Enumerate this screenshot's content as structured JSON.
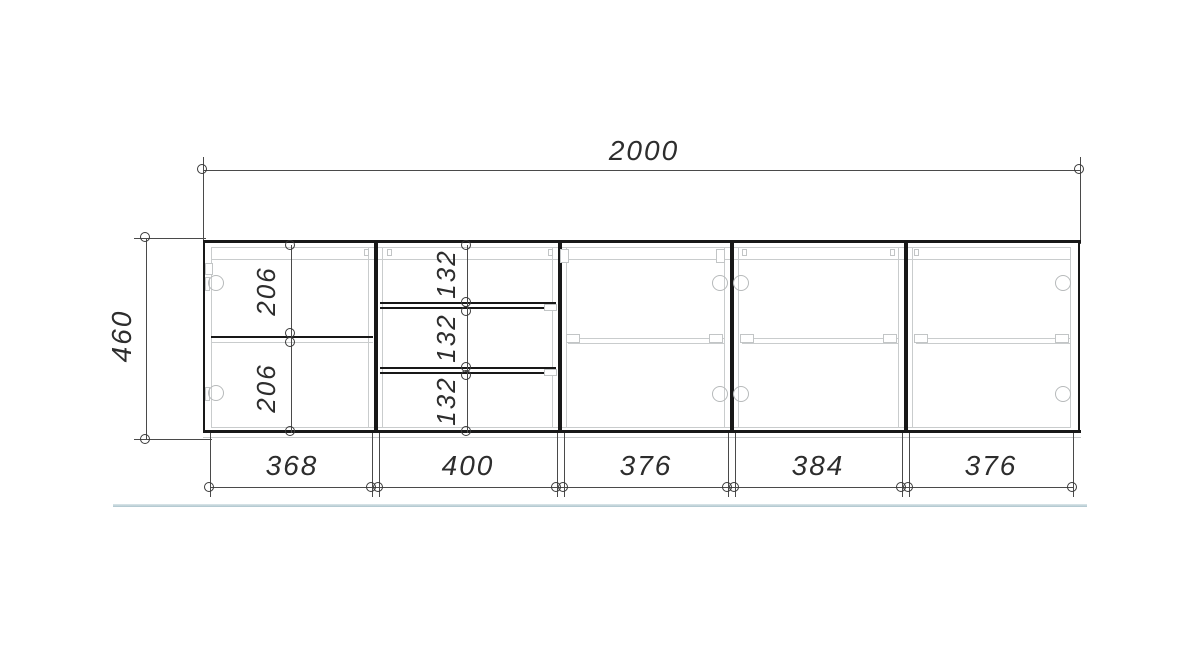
{
  "drawing": {
    "kind": "cabinet-front-elevation",
    "dims": {
      "total_width": "2000",
      "height": "460",
      "left_top": "206",
      "left_bottom": "206",
      "drawer1": "132",
      "drawer2": "132",
      "drawer3": "132",
      "w1": "368",
      "w2": "400",
      "w3": "376",
      "w4": "384",
      "w5": "376"
    },
    "section_widths": [
      "368",
      "400",
      "376",
      "384",
      "376"
    ],
    "colors": {
      "outline": "#181818",
      "dimension_line": "#4a4a4a",
      "detail_gray": "#c9cccd",
      "hinge_gray": "#b7babb",
      "text": "#2d2d2d",
      "floor_line": "#adc4cd",
      "background": "#ffffff"
    }
  }
}
